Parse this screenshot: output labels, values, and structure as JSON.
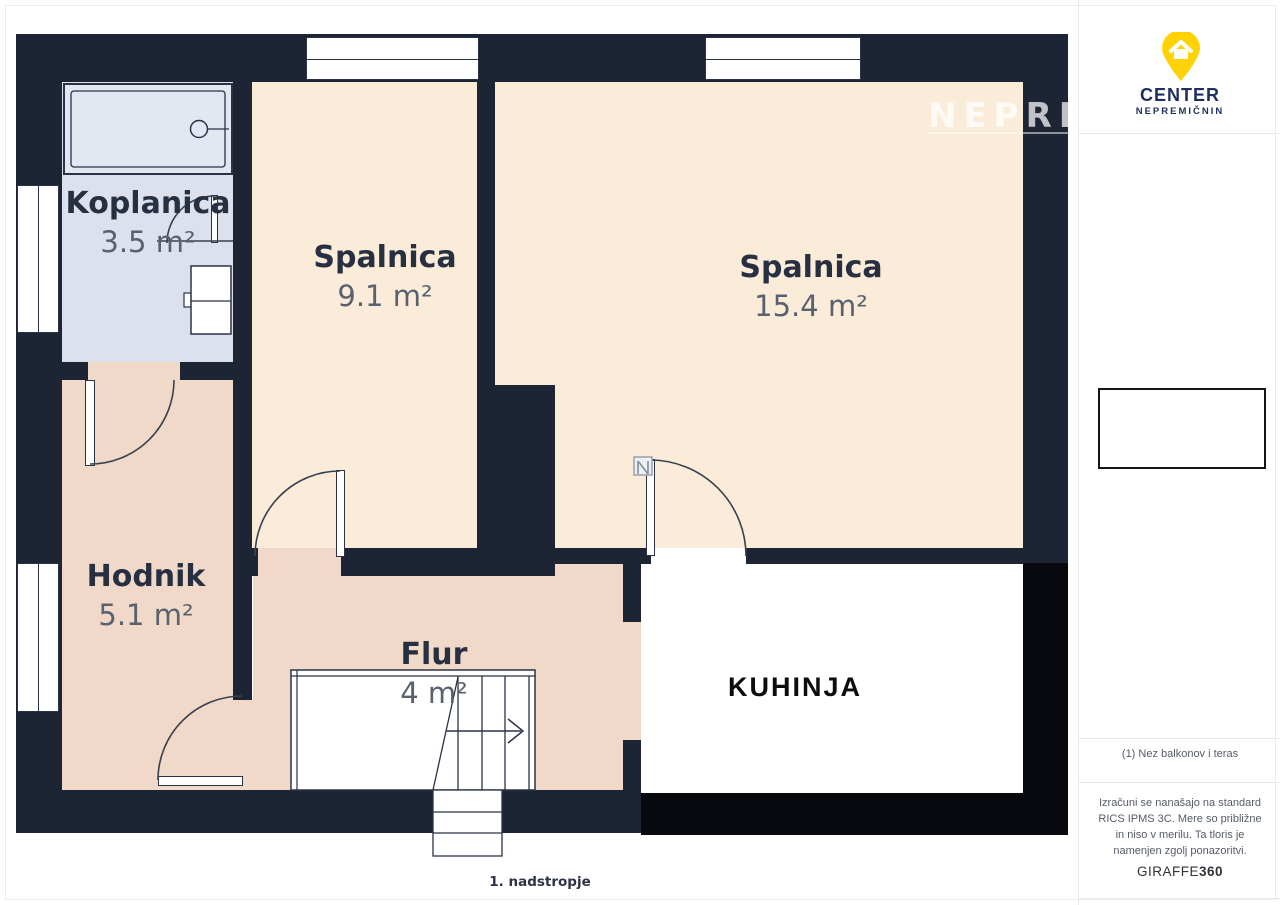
{
  "plan": {
    "rooms": [
      {
        "name": "Koplanica",
        "area": "3.5 m²"
      },
      {
        "name": "Spalnica",
        "area": "9.1 m²"
      },
      {
        "name": "Spalnica",
        "area": "15.4 m²"
      },
      {
        "name": "Hodnik",
        "area": "5.1 m²"
      },
      {
        "name": "Flur",
        "area": "4 m²"
      },
      {
        "name": "KUHINJA",
        "area": ""
      }
    ],
    "caption": "1. nadstropje",
    "watermark": "NEPREMIČ"
  },
  "sidebar": {
    "logo": {
      "line1": "CENTER",
      "line2": "NEPREMIČNIN"
    },
    "note": "(1) Nez balkonov i teras",
    "disclaimer": "Izračuni se nanašajo na standard RICS IPMS 3C. Mere so približne in niso v merilu. Ta tloris je namenjen zgolj ponazoritvi.",
    "brand": {
      "name": "GIRAFFE",
      "suffix": "360"
    }
  },
  "colors": {
    "wall_navy": "#1d2433",
    "wall_black": "#07090e",
    "room_cream": "#fbecda",
    "room_pink": "#f0d9c8",
    "room_bath": "#dce1ed",
    "logo_yellow": "#ffd203",
    "logo_navy": "#1d2f5d",
    "label_navy": "#273041",
    "label_gray": "#59616f"
  }
}
